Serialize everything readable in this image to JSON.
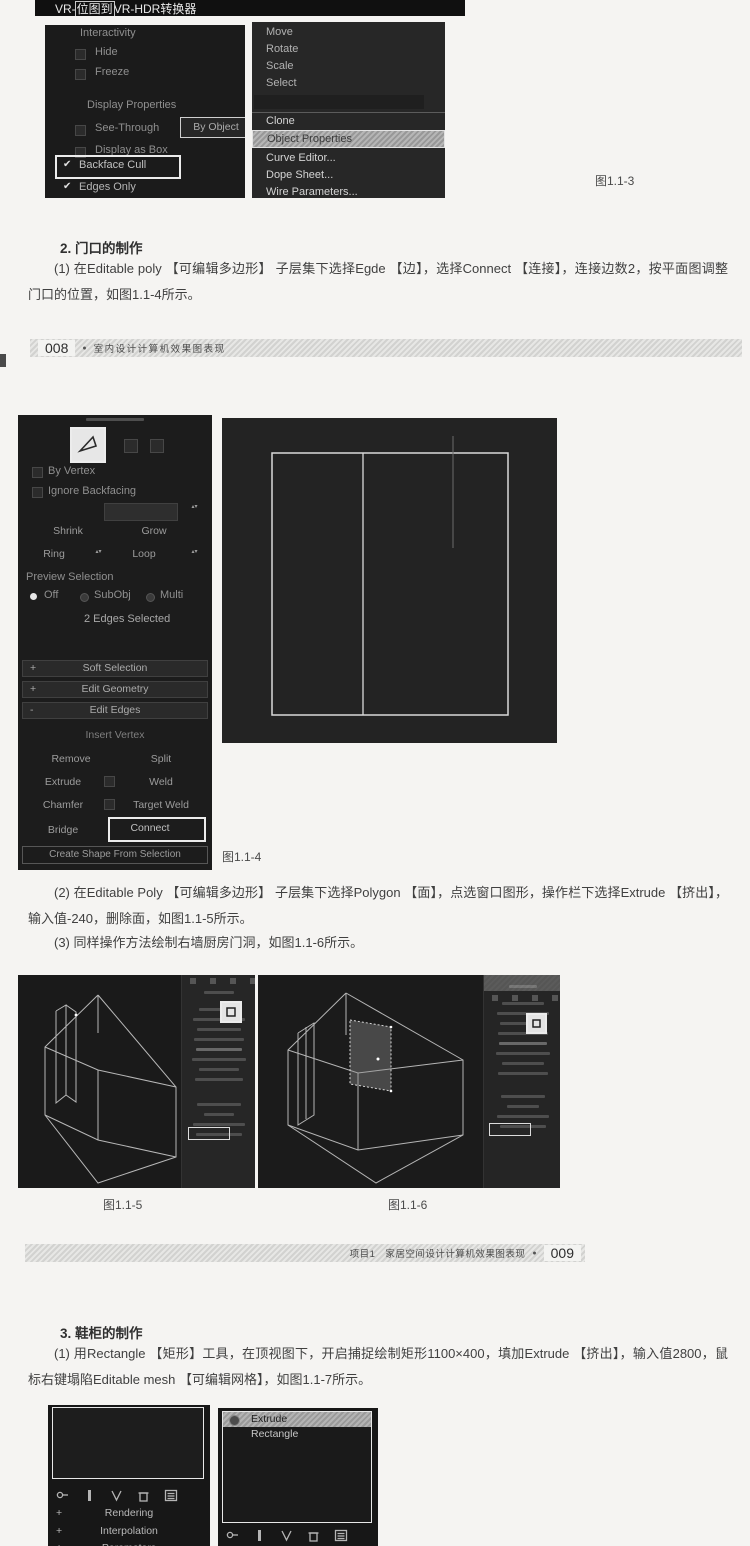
{
  "colors": {
    "page_bg": "#f5f4f2",
    "screenshot_bg": "#1d1d1d",
    "panel_text": "#9c9c9c",
    "highlight_border": "#ffffff",
    "body_text": "#404040"
  },
  "icons": {
    "check": "✔",
    "spinner_up": "▴",
    "spinner_down": "▾"
  },
  "figure3": {
    "title_prefix": "VR-",
    "title_boxed": "位图到",
    "title_suffix": "VR-HDR转换器",
    "properties_panel": {
      "interactivity": "Interactivity",
      "hide": "Hide",
      "freeze": "Freeze",
      "display_properties": "Display Properties",
      "see_through": "See-Through",
      "by_object": "By Object",
      "display_as_box": "Display as Box",
      "backface_cull": "Backface Cull",
      "edges_only": "Edges Only"
    },
    "quad_menu": {
      "move": "Move",
      "rotate": "Rotate",
      "scale": "Scale",
      "select": "Select",
      "clone": "Clone",
      "object_properties": "Object Properties",
      "curve_editor": "Curve Editor...",
      "dope_sheet": "Dope Sheet...",
      "wire_parameters": "Wire Parameters..."
    },
    "caption": "图1.1-3"
  },
  "section2": {
    "heading": "2. 门口的制作",
    "para1": "(1) 在Editable poly 【可编辑多边形】 子层集下选择Egde 【边】，选择Connect 【连接】，连接边数2，按平面图调整门口的位置，如图1.1-4所示。",
    "para2": "(2) 在Editable Poly 【可编辑多边形】 子层集下选择Polygon 【面】，点选窗口图形，操作栏下选择Extrude 【挤出】，输入值-240，删除面，如图1.1-5所示。",
    "para3": "(3) 同样操作方法绘制右墙厨房门洞，如图1.1-6所示。"
  },
  "header008": {
    "page_num": "008",
    "bullet": "●",
    "title": "室内设计计算机效果图表现"
  },
  "figure4": {
    "caption": "图1.1-4",
    "selection_panel": {
      "by_vertex": "By Vertex",
      "ignore_backfacing": "Ignore Backfacing",
      "shrink": "Shrink",
      "grow": "Grow",
      "ring": "Ring",
      "loop": "Loop",
      "preview_selection": "Preview Selection",
      "off": "Off",
      "subobj": "SubObj",
      "multi": "Multi",
      "status": "2 Edges Selected",
      "plus": "+",
      "minus": "-",
      "soft_selection": "Soft Selection",
      "edit_geometry": "Edit Geometry",
      "edit_edges": "Edit Edges",
      "insert_vertex": "Insert Vertex",
      "remove": "Remove",
      "split": "Split",
      "extrude": "Extrude",
      "weld": "Weld",
      "chamfer": "Chamfer",
      "target_weld": "Target Weld",
      "bridge": "Bridge",
      "connect": "Connect",
      "create_shape": "Create Shape From Selection"
    }
  },
  "figure5": {
    "caption": "图1.1-5"
  },
  "figure6": {
    "caption": "图1.1-6"
  },
  "header009": {
    "chapter": "项目1",
    "title": "家居空间设计计算机效果图表现",
    "bullet": "●",
    "page_num": "009"
  },
  "section3": {
    "heading": "3. 鞋柜的制作",
    "para1": "(1) 用Rectangle 【矩形】工具，在顶视图下，开启捕捉绘制矩形1100×400，填加Extrude 【挤出】，输入值2800，鼠标右键塌陷Editable mesh 【可编辑网格】，如图1.1-7所示。"
  },
  "figure7": {
    "left_panel": {
      "plus": "+",
      "rendering": "Rendering",
      "interpolation": "Interpolation",
      "parameters": "Parameters"
    },
    "right_panel": {
      "stack": [
        "Extrude",
        "Rectangle"
      ]
    }
  }
}
